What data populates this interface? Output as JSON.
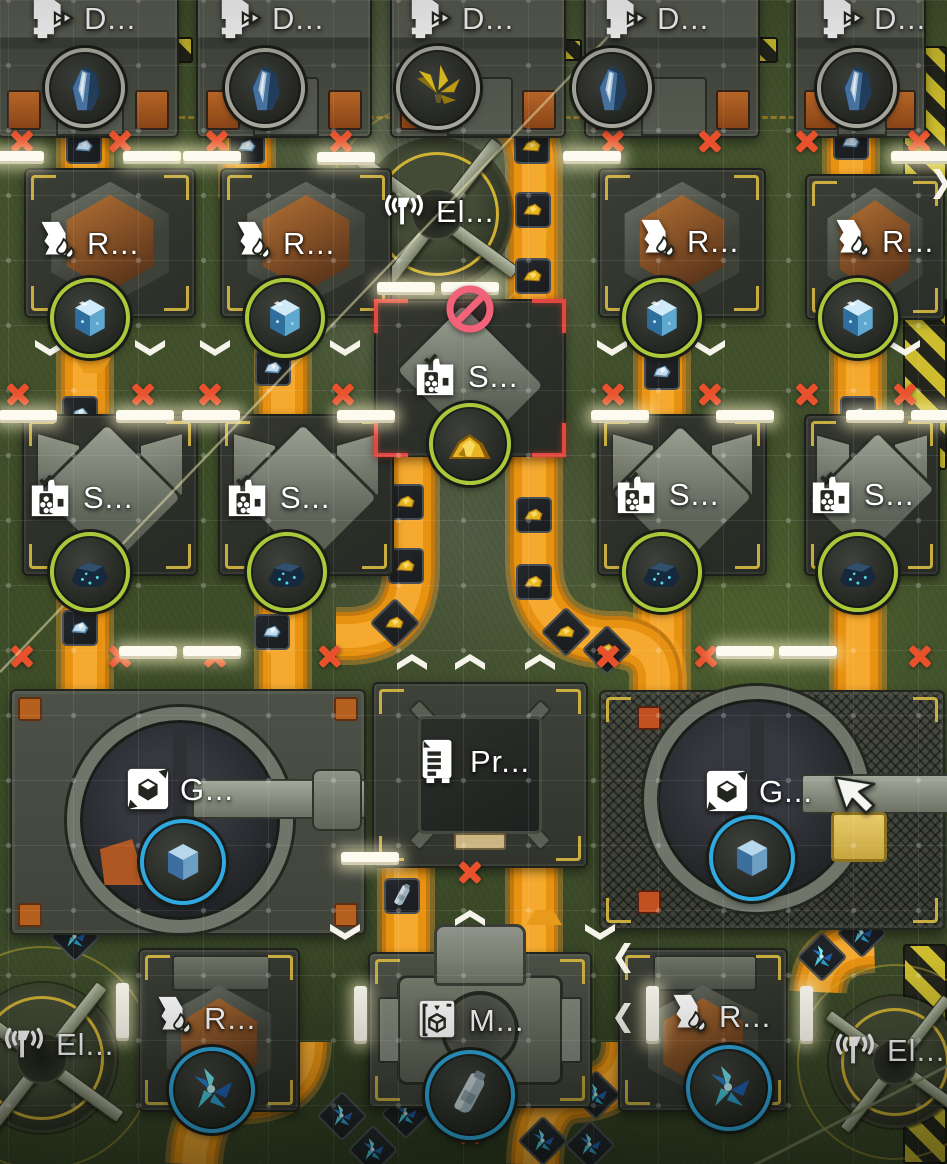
{
  "scene": {
    "w": 947,
    "h": 1164
  },
  "labels_text": {
    "drill": "D...",
    "ref": "R...",
    "smelt": "S...",
    "grind": "G...",
    "press": "Pr...",
    "mold": "M...",
    "power": "El..."
  },
  "colors": {
    "conveyor": "#e08d12",
    "ring_green": "#a9c93b",
    "ring_blue": "#2fa9e0",
    "ring_gray": "#a9a9a0",
    "x_mark": "#e8512c",
    "hazard": "#cdbd2e",
    "selection": "#e04840",
    "prohibit": "#f26379",
    "label": "#ffffff"
  },
  "tiles": [
    [
      "drill",
      88,
      45,
      182,
      186
    ],
    [
      "drill",
      284,
      45,
      176,
      186
    ],
    [
      "drill",
      478,
      45,
      176,
      186
    ],
    [
      "drill",
      672,
      45,
      176,
      186
    ],
    [
      "drill",
      860,
      45,
      132,
      186
    ],
    [
      "ref",
      110,
      243,
      172,
      150
    ],
    [
      "ref",
      306,
      243,
      172,
      150
    ],
    [
      "ref",
      682,
      243,
      168,
      150
    ],
    [
      "ref",
      875,
      247,
      140,
      146
    ],
    [
      "smelt",
      110,
      495,
      176,
      162
    ],
    [
      "smelt",
      306,
      495,
      176,
      162
    ],
    [
      "smelt",
      682,
      495,
      170,
      162
    ],
    [
      "smelt",
      872,
      495,
      136,
      162
    ],
    [
      "smeltsel",
      470,
      378,
      192,
      158
    ],
    [
      "grindl",
      188,
      812,
      356,
      246
    ],
    [
      "grindr",
      772,
      810,
      346,
      240
    ],
    [
      "press",
      480,
      775,
      216,
      186
    ],
    [
      "ramp",
      480,
      955,
      92,
      62
    ],
    [
      "mold",
      480,
      1030,
      224,
      156
    ],
    [
      "refb",
      219,
      1030,
      162,
      164
    ],
    [
      "refb",
      703,
      1030,
      170,
      164
    ],
    [
      "pad",
      437,
      214,
      150,
      150
    ],
    [
      "pad",
      42,
      1058,
      150,
      150
    ],
    [
      "pad",
      895,
      1062,
      132,
      132
    ]
  ],
  "hazards": [
    [
      925,
      114,
      44,
      136
    ],
    [
      925,
      384,
      44,
      172
    ],
    [
      925,
      1054,
      44,
      220
    ],
    [
      176,
      50,
      34,
      26
    ],
    [
      357,
      50,
      28,
      22
    ],
    [
      568,
      50,
      28,
      22
    ],
    [
      762,
      50,
      32,
      26
    ]
  ],
  "belts": [
    "M 452,86 Q 532,96 534,166 L 534,310",
    "M 85,96 L 85,198",
    "M 247,96 L 247,198",
    "M 851,94 L 851,198",
    "M 85,303 L 85,462",
    "M 283,303 L 283,462",
    "M 662,303 L 662,462",
    "M 858,303 L 858,462",
    "M 85,554 L 85,700",
    "M 283,554 L 283,700",
    "M 662,554 L 662,700",
    "M 858,554 L 858,700",
    "M 411,444 L 411,568 Q 411,633 352,636 L 336,636",
    "M 534,444 L 534,560 Q 534,634 604,640 L 622,640 Q 656,645 658,676 L 658,694",
    "M 406,856 L 406,988",
    "M 534,856 L 534,988",
    "M 303,1042 Q 303,1092 248,1095 Q 196,1097 194,1164",
    "M 630,1042 Q 630,1090 578,1094 Q 536,1096 535,1164",
    "M 874,944 Q 820,946 818,992"
  ],
  "items": {
    "gold": [
      [
        532,
        146
      ],
      [
        533,
        210
      ],
      [
        533,
        276
      ],
      [
        406,
        502
      ],
      [
        406,
        566
      ],
      [
        395,
        623,
        1
      ],
      [
        534,
        515
      ],
      [
        534,
        582
      ],
      [
        566,
        632,
        1
      ],
      [
        607,
        650,
        1
      ]
    ],
    "blue": [
      [
        84,
        146
      ],
      [
        247,
        146
      ],
      [
        851,
        142
      ],
      [
        80,
        414
      ],
      [
        273,
        368
      ],
      [
        662,
        372
      ],
      [
        858,
        414
      ],
      [
        80,
        628
      ],
      [
        272,
        632
      ]
    ],
    "canister": [
      [
        402,
        896
      ]
    ],
    "crystal": [
      [
        342,
        1116
      ],
      [
        406,
        1114
      ],
      [
        373,
        1150
      ],
      [
        543,
        1141
      ],
      [
        596,
        1095
      ],
      [
        590,
        1145
      ],
      [
        822,
        957
      ],
      [
        862,
        933
      ],
      [
        75,
        937
      ]
    ]
  },
  "badges": [
    [
      "tower",
      "gray",
      85,
      88,
      80
    ],
    [
      "tower",
      "gray",
      265,
      88,
      80
    ],
    [
      "tower",
      "gray",
      612,
      88,
      80
    ],
    [
      "tower",
      "gray",
      857,
      88,
      80
    ],
    [
      "plant",
      "gray",
      438,
      88,
      84
    ],
    [
      "bluecube",
      "green",
      90,
      318,
      80
    ],
    [
      "bluecube",
      "green",
      285,
      318,
      80
    ],
    [
      "bluecube",
      "green",
      662,
      318,
      80
    ],
    [
      "bluecube",
      "green",
      858,
      318,
      80
    ],
    [
      "rock",
      "green",
      90,
      572,
      80
    ],
    [
      "rock",
      "green",
      287,
      572,
      80
    ],
    [
      "rock",
      "green",
      662,
      572,
      80
    ],
    [
      "rock",
      "green",
      858,
      572,
      80
    ],
    [
      "goldpile",
      "green",
      470,
      444,
      82
    ],
    [
      "cube",
      "blue",
      183,
      862,
      86
    ],
    [
      "cube",
      "blue",
      752,
      858,
      86
    ],
    [
      "crystal",
      "blue",
      212,
      1090,
      86
    ],
    [
      "crystal",
      "blue",
      729,
      1088,
      86
    ],
    [
      "canister",
      "blue",
      470,
      1095,
      90
    ]
  ],
  "labels": [
    [
      "drill",
      52,
      18
    ],
    [
      "drill",
      240,
      18
    ],
    [
      "drill",
      430,
      18
    ],
    [
      "drill",
      625,
      18
    ],
    [
      "drill",
      842,
      18
    ],
    [
      "power",
      404,
      211
    ],
    [
      "power",
      24,
      1044
    ],
    [
      "power",
      855,
      1050
    ],
    [
      "ref",
      55,
      243
    ],
    [
      "ref",
      251,
      243
    ],
    [
      "ref",
      655,
      241
    ],
    [
      "ref",
      850,
      241
    ],
    [
      "smelt",
      51,
      497
    ],
    [
      "smelt",
      248,
      497
    ],
    [
      "smelt",
      637,
      494
    ],
    [
      "smelt",
      832,
      494
    ],
    [
      "smelt",
      436,
      376
    ],
    [
      "grind",
      148,
      789
    ],
    [
      "grind",
      727,
      791
    ],
    [
      "press",
      438,
      761
    ],
    [
      "mold",
      437,
      1020
    ],
    [
      "ref",
      172,
      1018
    ],
    [
      "ref",
      687,
      1016
    ]
  ],
  "xmarks": [
    [
      22,
      141
    ],
    [
      120,
      141
    ],
    [
      217,
      141
    ],
    [
      341,
      141
    ],
    [
      613,
      141
    ],
    [
      710,
      141
    ],
    [
      807,
      141
    ],
    [
      919,
      141
    ],
    [
      18,
      394
    ],
    [
      143,
      394
    ],
    [
      210,
      394
    ],
    [
      343,
      394
    ],
    [
      613,
      394
    ],
    [
      710,
      394
    ],
    [
      807,
      394
    ],
    [
      905,
      394
    ],
    [
      22,
      656
    ],
    [
      120,
      656
    ],
    [
      215,
      656
    ],
    [
      330,
      656
    ],
    [
      608,
      656
    ],
    [
      706,
      656
    ],
    [
      920,
      656
    ],
    [
      470,
      872
    ],
    [
      470,
      1133
    ]
  ],
  "chevrons": {
    "down": [
      [
        50,
        348
      ],
      [
        150,
        348
      ],
      [
        215,
        348
      ],
      [
        345,
        348
      ],
      [
        612,
        348
      ],
      [
        710,
        348
      ],
      [
        905,
        348
      ],
      [
        470,
        480
      ],
      [
        345,
        932
      ],
      [
        600,
        932
      ]
    ],
    "up": [
      [
        412,
        662
      ],
      [
        470,
        662
      ],
      [
        540,
        662
      ],
      [
        470,
        918
      ]
    ],
    "left": [
      [
        623,
        958
      ],
      [
        623,
        1018
      ]
    ],
    "right": [
      [
        941,
        184
      ]
    ]
  },
  "ports": {
    "h": [
      [
        15,
        157
      ],
      [
        152,
        157
      ],
      [
        212,
        157
      ],
      [
        346,
        158
      ],
      [
        592,
        157
      ],
      [
        920,
        157
      ],
      [
        406,
        288
      ],
      [
        470,
        288
      ],
      [
        28,
        416
      ],
      [
        145,
        416
      ],
      [
        211,
        416
      ],
      [
        366,
        416
      ],
      [
        620,
        416
      ],
      [
        745,
        416
      ],
      [
        875,
        416
      ],
      [
        940,
        416
      ],
      [
        148,
        652
      ],
      [
        212,
        652
      ],
      [
        745,
        652
      ],
      [
        808,
        652
      ],
      [
        370,
        858
      ]
    ],
    "v": [
      [
        122,
        1012
      ],
      [
        360,
        1015
      ],
      [
        652,
        1015
      ],
      [
        806,
        1015
      ]
    ]
  },
  "tris": [
    [
      "up",
      535,
      902
    ],
    [
      "down",
      84,
      365
    ]
  ],
  "wires": [
    [
      0,
      672,
      624,
      20,
      "rgba(240,232,180,0.5)",
      2.5
    ],
    [
      735,
      1175,
      955,
      1062,
      "rgba(120,128,92,0.9)",
      3
    ]
  ],
  "prohibition": {
    "x": 470,
    "y": 309
  },
  "cursor": {
    "x": 858,
    "y": 796
  }
}
